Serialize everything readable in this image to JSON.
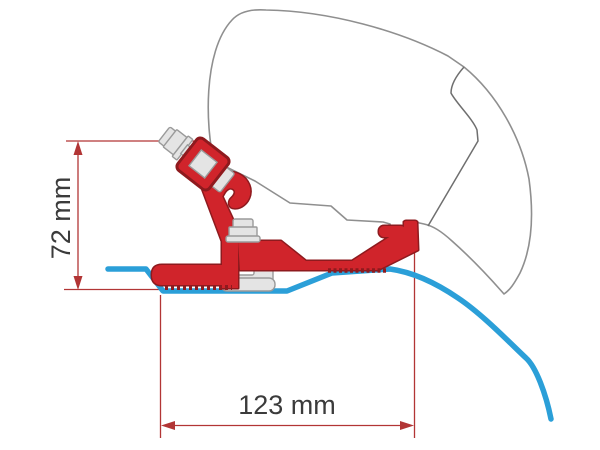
{
  "diagram": {
    "dimensions": {
      "height": {
        "label": "72 mm"
      },
      "width": {
        "label": "123 mm"
      }
    },
    "colors": {
      "bracket": "#d0242b",
      "bracket_outline": "#8e1a1e",
      "roof_profile": "#2b9fd8",
      "dimension": "#b23535",
      "label_text": "#3b3b3b",
      "case_outline": "#8f8f8f",
      "case_seam": "#6f6f6f",
      "hardware_fill": "#e4e4e4",
      "hardware_stroke": "#9a9a9a",
      "white": "#ffffff"
    }
  }
}
